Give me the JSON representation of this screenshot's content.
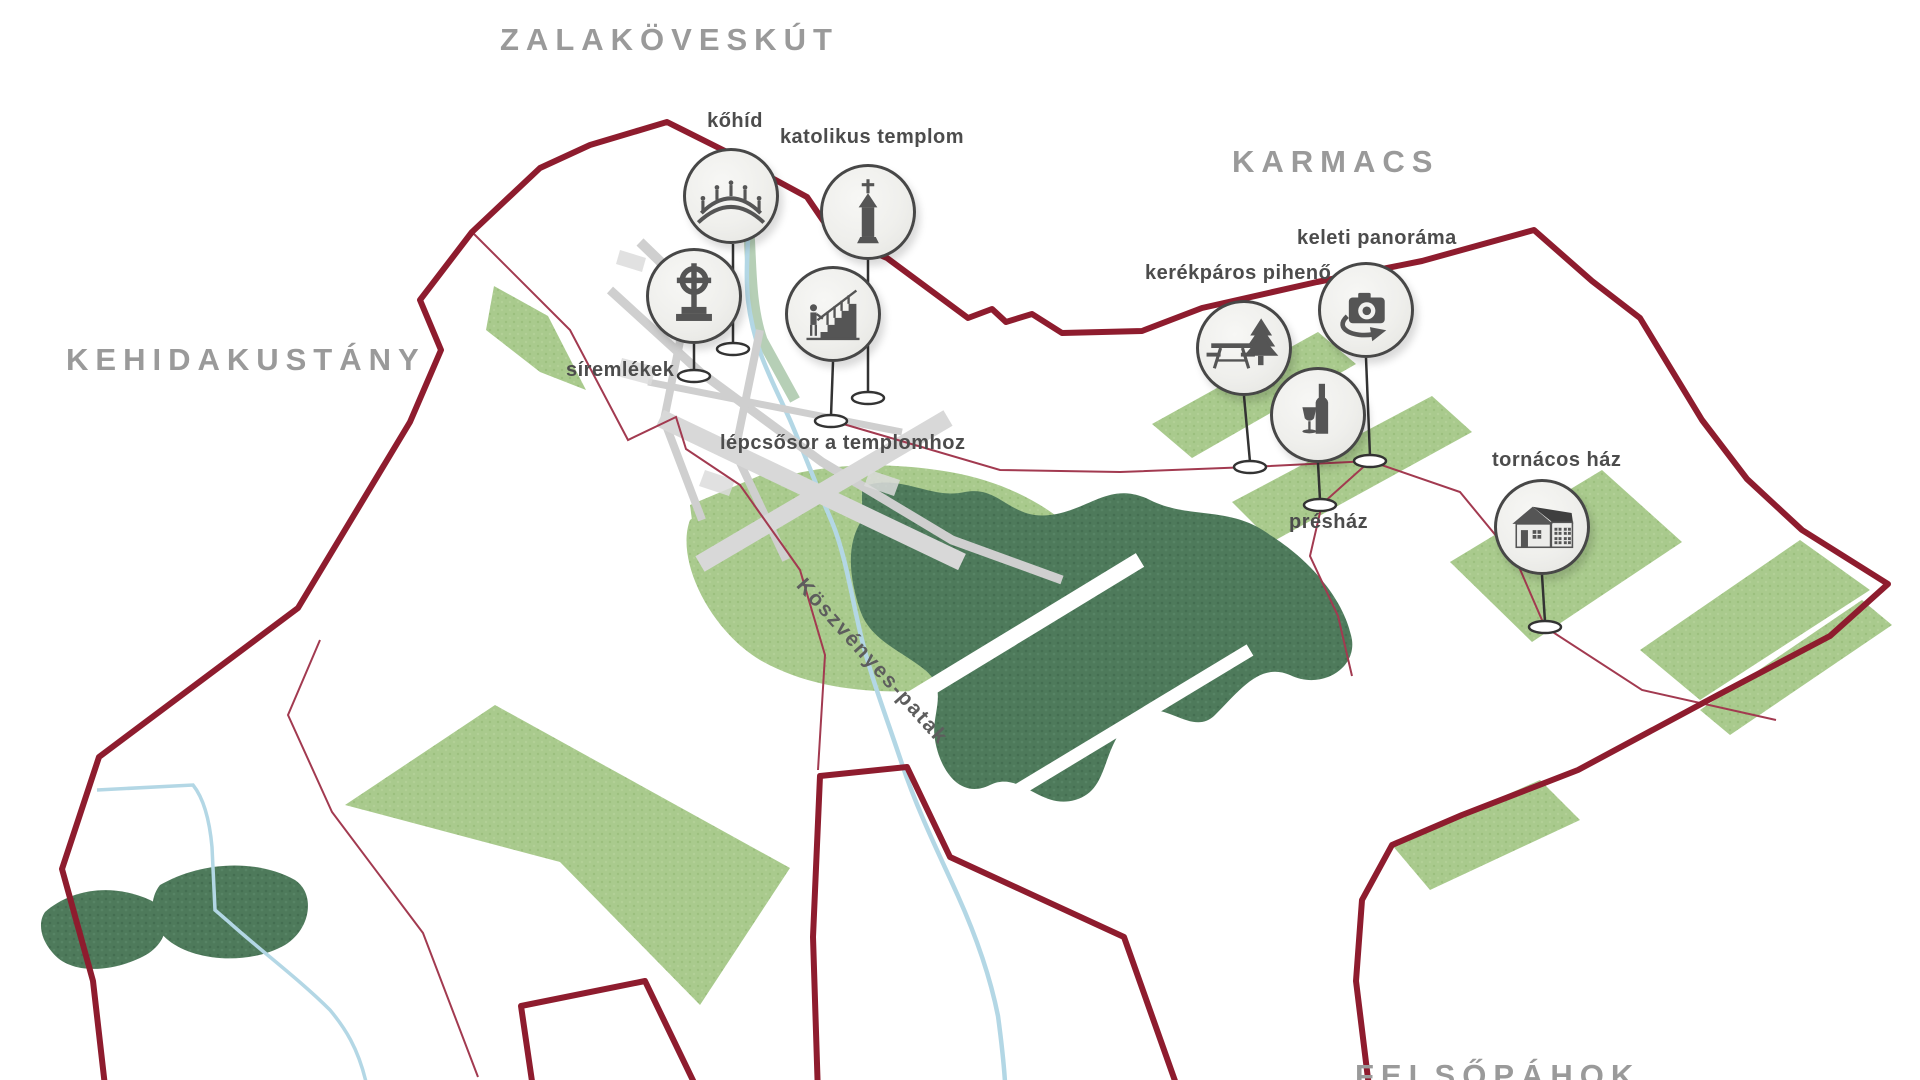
{
  "map": {
    "settlements": [
      {
        "name": "ZALAKÖVESKÚT"
      },
      {
        "name": "KEHIDAKUSTÁNY"
      },
      {
        "name": "KARMACS"
      },
      {
        "name": "FELSŐPÁHOK"
      }
    ],
    "stream_label": "Köszvényes-patak",
    "pois": [
      {
        "id": "kohid",
        "label": "kőhíd",
        "icon": "stone-bridge-icon"
      },
      {
        "id": "katolikus-templom",
        "label": "katolikus templom",
        "icon": "church-icon"
      },
      {
        "id": "siremlekek",
        "label": "síremlékek",
        "icon": "grave-cross-icon"
      },
      {
        "id": "lepcsosor",
        "label": "lépcsősor a templomhoz",
        "icon": "stairs-icon"
      },
      {
        "id": "kerekparos-piheno",
        "label": "kerékpáros pihenő",
        "icon": "picnic-table-icon"
      },
      {
        "id": "keleti-panorama",
        "label": "keleti panoráma",
        "icon": "panorama-camera-icon"
      },
      {
        "id": "preshaz",
        "label": "présház",
        "icon": "wine-bottle-icon"
      },
      {
        "id": "tornacos-haz",
        "label": "tornácos ház",
        "icon": "porch-house-icon"
      }
    ],
    "colors": {
      "boundary_red": "#8e1c2e",
      "thin_road_red": "#a23a50",
      "field_green": "#a9ca8d",
      "forest_green": "#4e7a5b",
      "stream_blue": "#b3d7e5",
      "road_gray": "#cfcfcf",
      "settlement_label_gray": "#9a9a9a",
      "poi_label_gray": "#4c4c4c",
      "icon_gray": "#555555"
    }
  }
}
